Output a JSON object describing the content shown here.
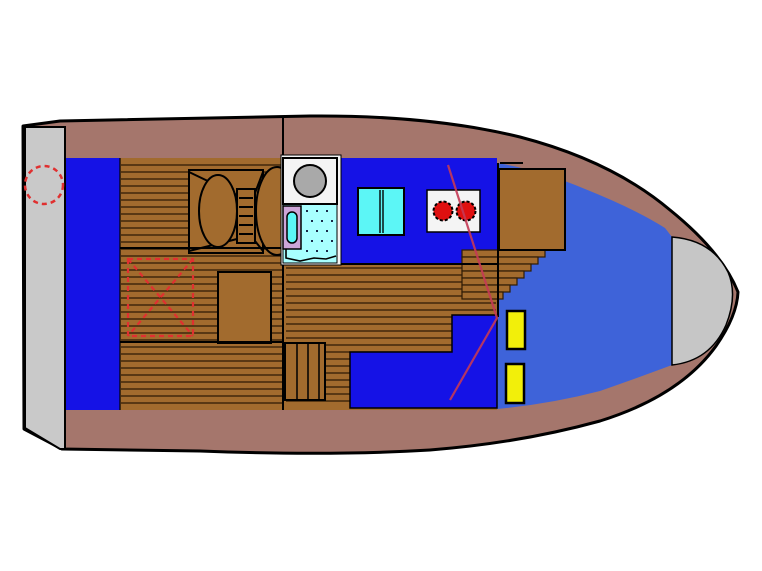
{
  "diagram": {
    "kind": "boat-deck-floor-plan",
    "orientation": "bow-right-stern-left"
  },
  "icons": [
    "mooring-ring-icon",
    "double-berth-icon",
    "berth-ladder-icon",
    "storage-box-icon",
    "dashed-hatch-marker-icon",
    "wash-basin-icon",
    "toilet-icon",
    "shower-floor-icon",
    "fridge-cabinet-icon",
    "stove-burners-icon",
    "helm-seat-icon",
    "companionway-steps-icon",
    "saloon-steps-icon",
    "locker-icon",
    "helm-cable-line-icon",
    "bow-deck-icon",
    "stern-platform-icon"
  ],
  "colors": {
    "background": "#FFFFFF",
    "outline": "#000000",
    "hull_band": "#A5766C",
    "stern_platform": "#C9C9C9",
    "bow_deck": "#C6C6C6",
    "deck_blue": "#1512E6",
    "cabin_blue": "#3E63D9",
    "wood": "#A26B2E",
    "wood_line": "#2E1B05",
    "bathroom_white": "#F4F4F4",
    "basin_gray": "#A9A9A9",
    "shower_cyan": "#A8FFFF",
    "cabinet_cyan": "#5CF6F6",
    "toilet_lavender": "#CDA6D8",
    "burner_red": "#DF1010",
    "locker_yellow": "#F2EF0A",
    "marker_red": "#E03030",
    "cable_red": "#C43A55",
    "dot": "#1A2A4A"
  },
  "planks": [
    {
      "target": "planks-a",
      "x1": 121,
      "x2": 284,
      "y0": 165,
      "y1": 406,
      "gap": 7
    },
    {
      "target": "planks-b",
      "x1": 286,
      "x2": 496,
      "y0": 268,
      "y1": 405,
      "gap": 7
    }
  ],
  "dot_regions": [
    {
      "target": "shower-dots",
      "x0": 306,
      "y0": 210,
      "x1": 334,
      "y1": 257,
      "gx": 10,
      "gy": 10
    }
  ],
  "steps": {
    "right_of_wall": {
      "x": 462,
      "rows_y0": 250,
      "row_h": 7,
      "widths": [
        83,
        76,
        69,
        62,
        55,
        48,
        41
      ]
    },
    "saloon_box_lines_x": [
      297,
      308,
      319
    ]
  }
}
